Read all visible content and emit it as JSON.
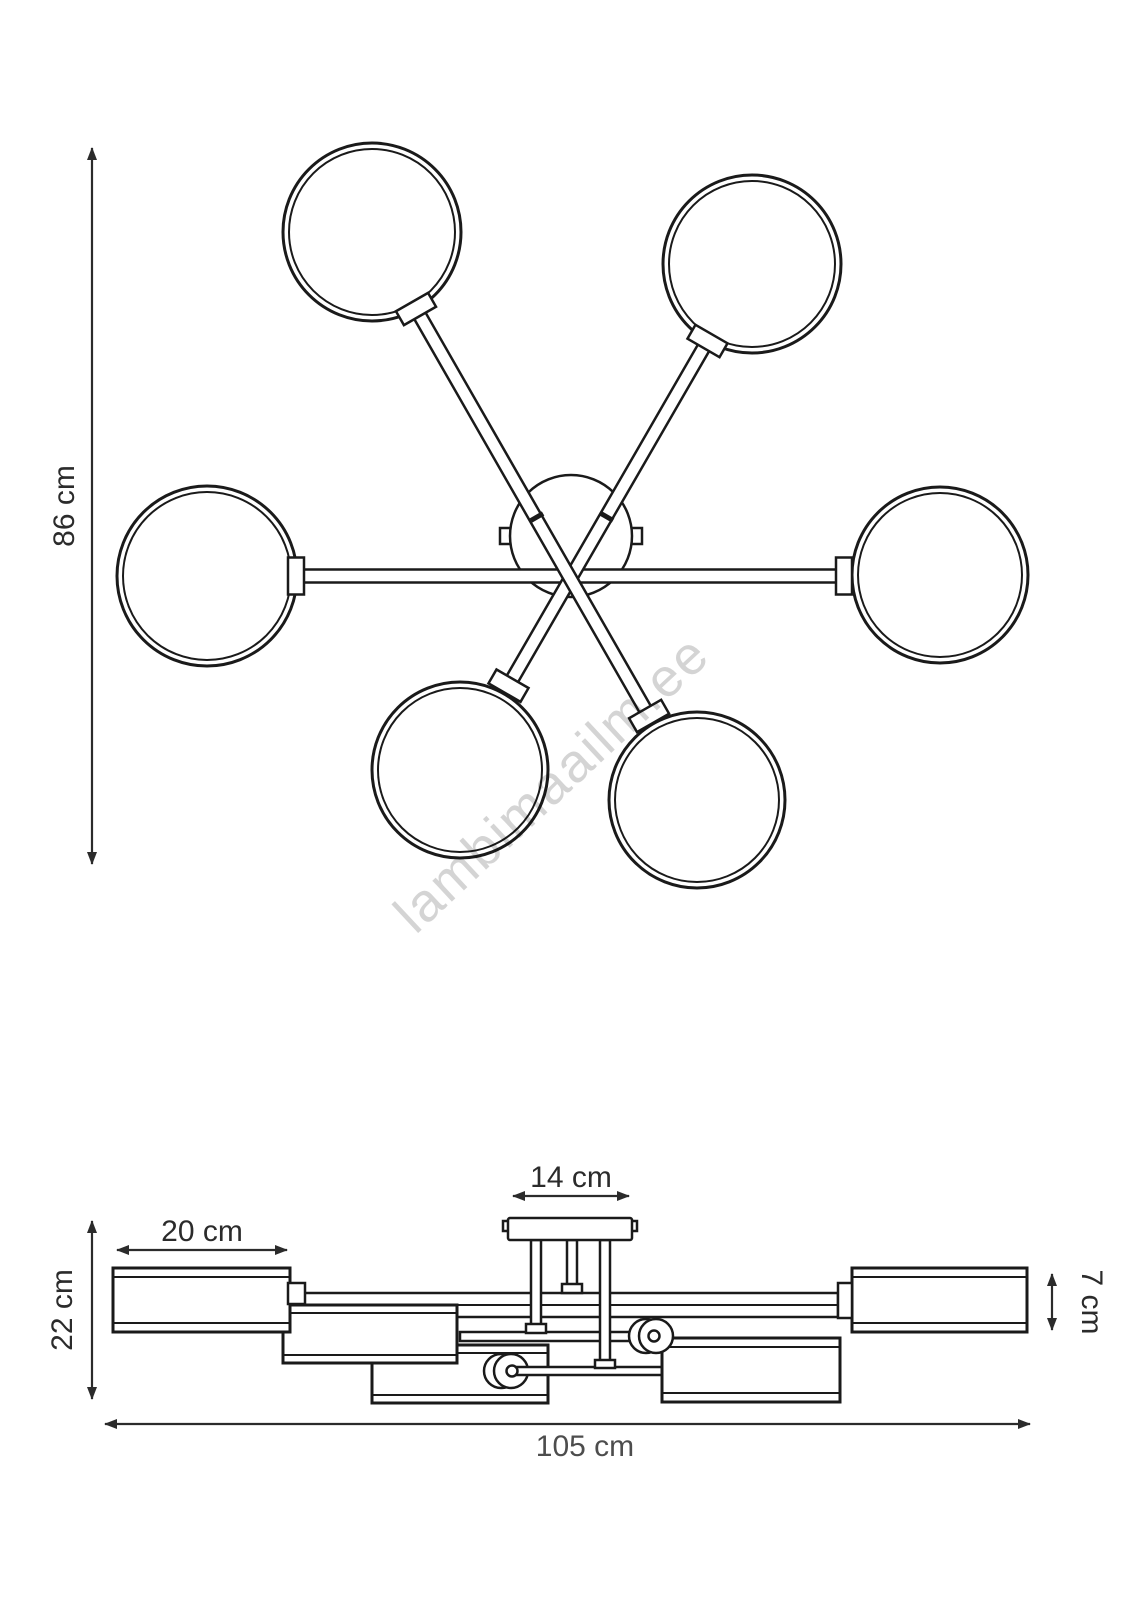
{
  "figure": {
    "views": {
      "plan": "six-shade ceiling light seen from below",
      "elevation": "six-shade ceiling light seen from the side"
    }
  },
  "dimensions": {
    "plan_height": "86 cm",
    "canopy_width": "14 cm",
    "shade_length": "20 cm",
    "fixture_height": "22 cm",
    "shade_height": "7 cm",
    "total_width": "105 cm"
  },
  "watermark": "lambimaailm.ee",
  "colors": {
    "line": "#1a1a1a",
    "dimension": "#2b2b2b",
    "watermark": "#cccccc",
    "background": "#ffffff"
  }
}
